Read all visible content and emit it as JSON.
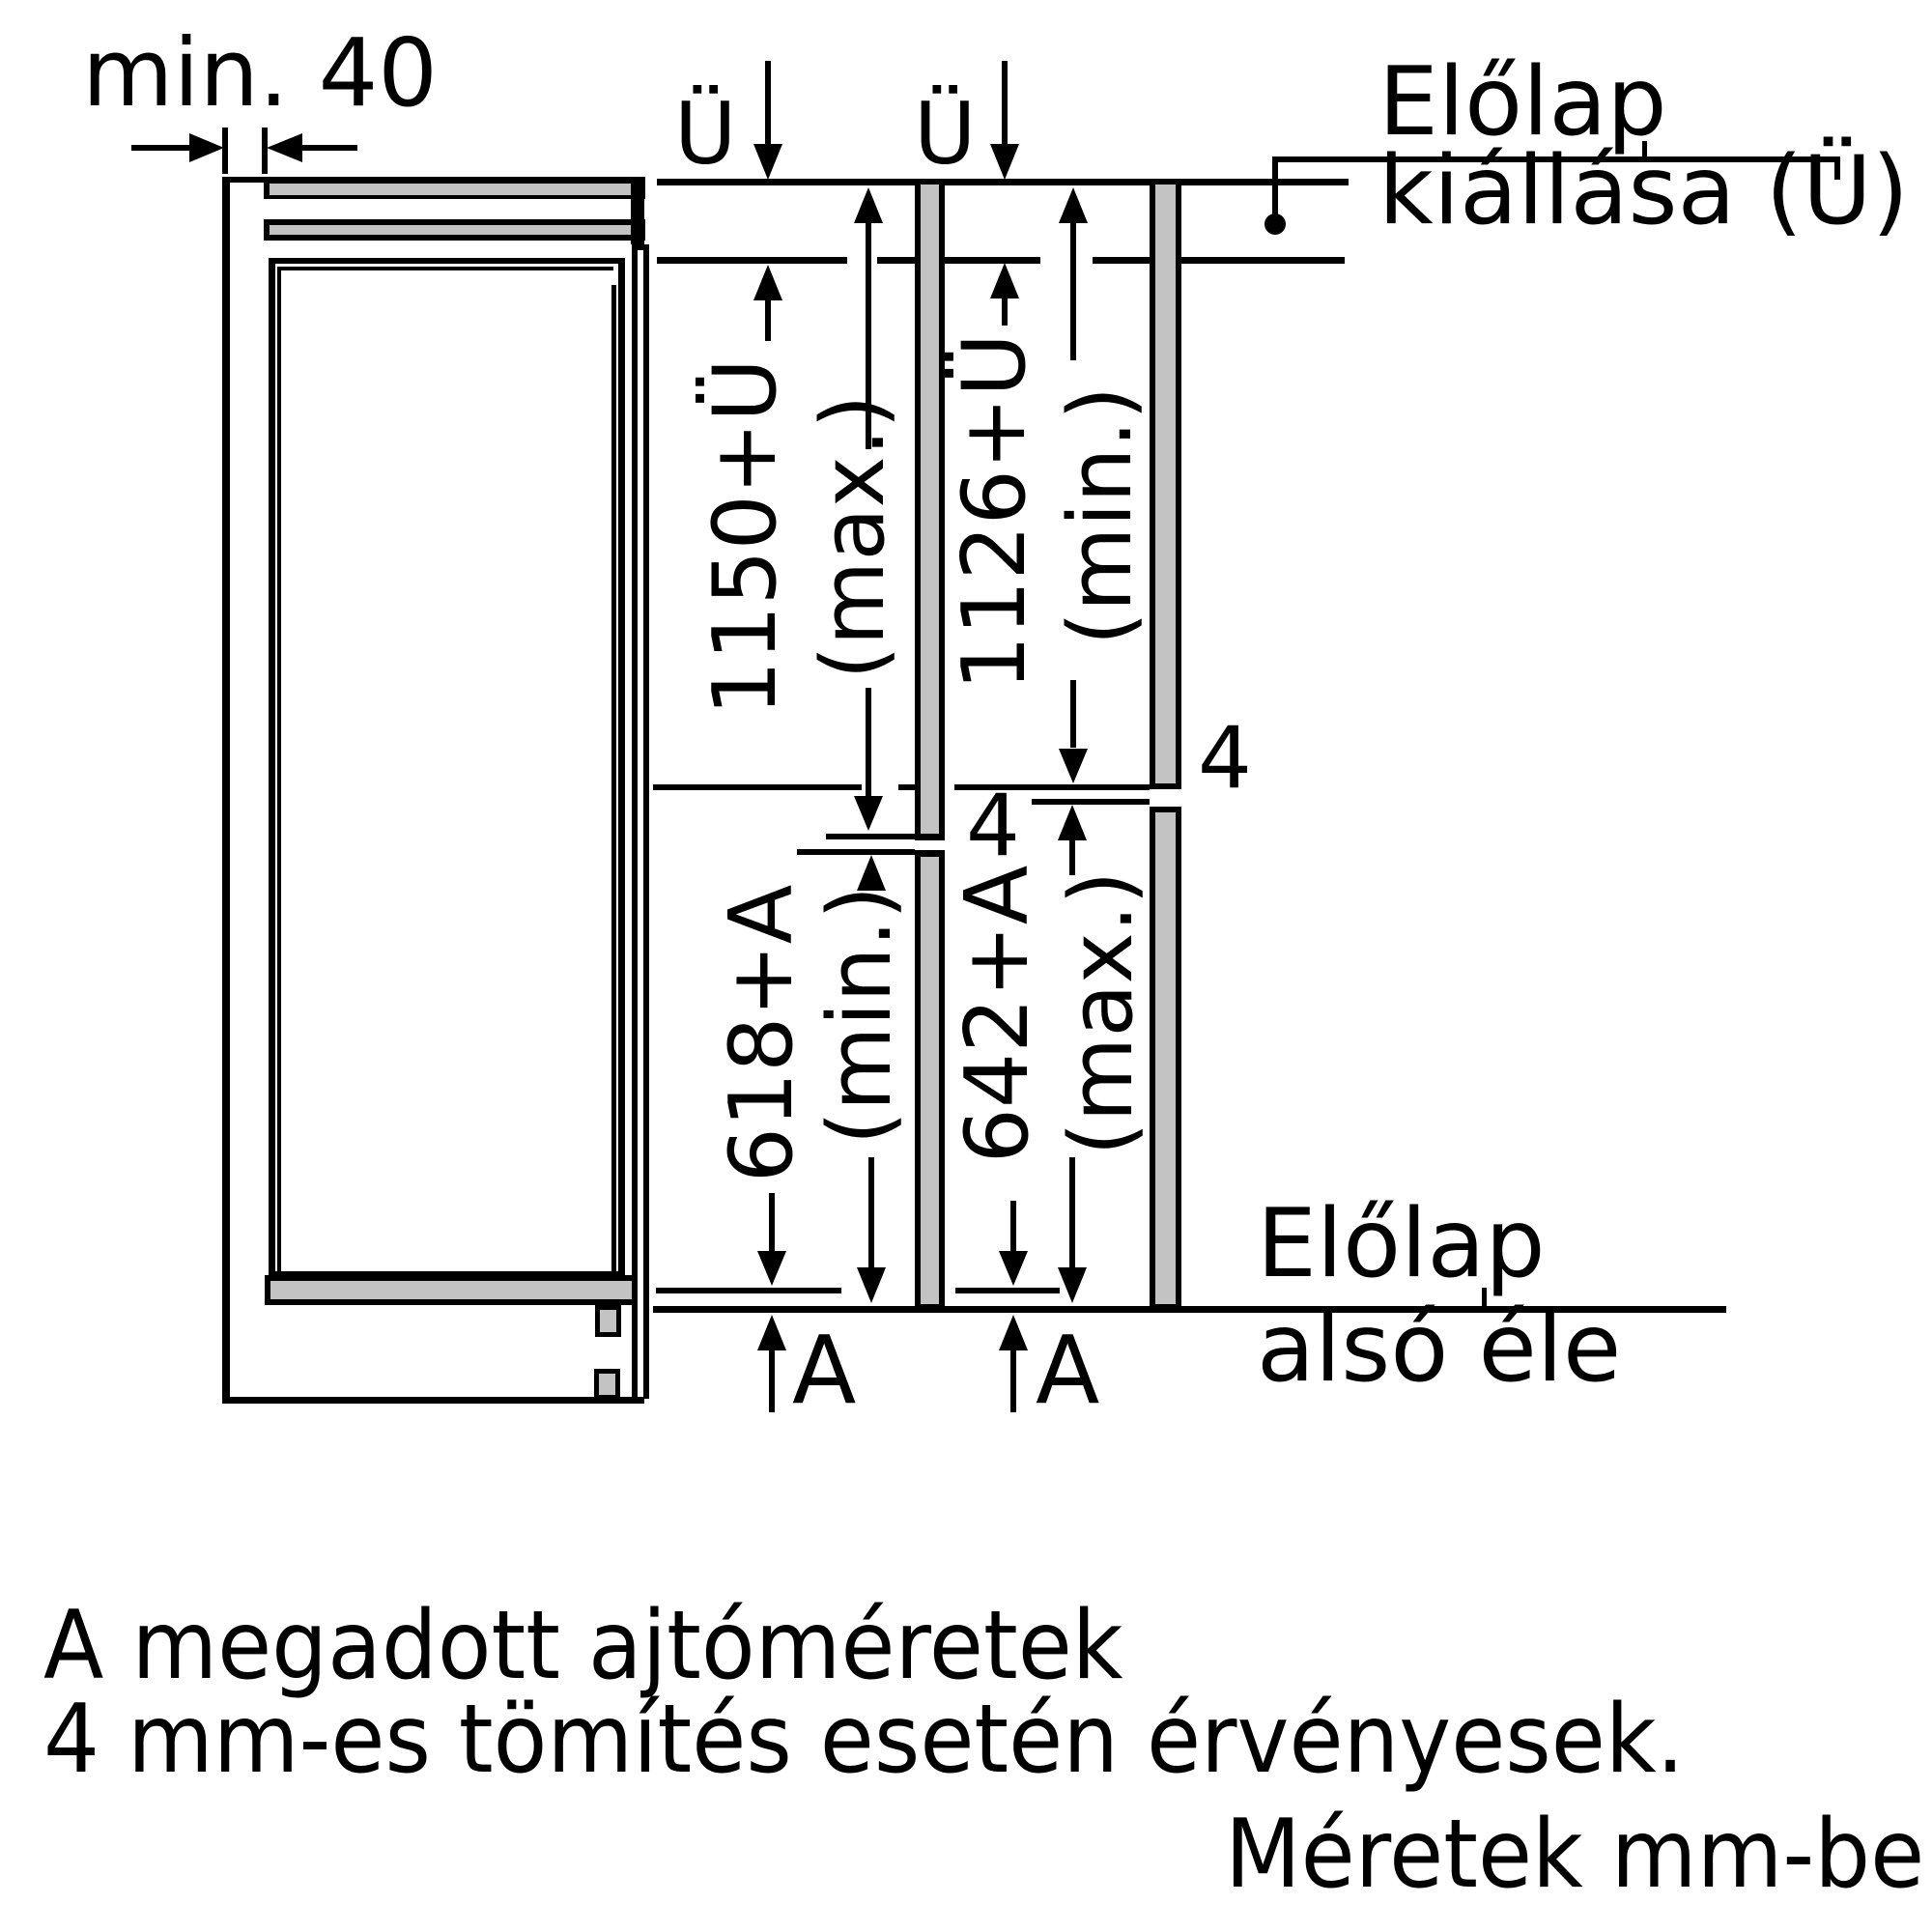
{
  "page": {
    "background": "#ffffff",
    "line_color": "#000000",
    "panel_gray": "#c3c3c3",
    "units_implied": "mm"
  },
  "top_dimension": {
    "label": "min. 40"
  },
  "overhang_top": {
    "u_left": "Ü",
    "u_right": "Ü"
  },
  "leader_top": {
    "line1": "Előlap",
    "line2": "kiállása (Ü)"
  },
  "columns": {
    "left": {
      "upper_value": "1150+Ü",
      "upper_qualifier": "(max.)",
      "lower_value": "618+A",
      "lower_qualifier": "(min.)",
      "gap_label": "4",
      "bottom_overhang_label": "A"
    },
    "right": {
      "upper_value": "1126+Ü",
      "upper_qualifier": "(min.)",
      "lower_value": "642+A",
      "lower_qualifier": "(max.)",
      "gap_label": "4",
      "bottom_overhang_label": "A"
    }
  },
  "leader_bottom": {
    "line1": "Előlap",
    "line2": "alsó éle"
  },
  "notes": {
    "line1": "A megadott ajtóméretek",
    "line2": "4 mm-es tömítés esetén érvényesek.",
    "units": "Méretek mm-be"
  }
}
